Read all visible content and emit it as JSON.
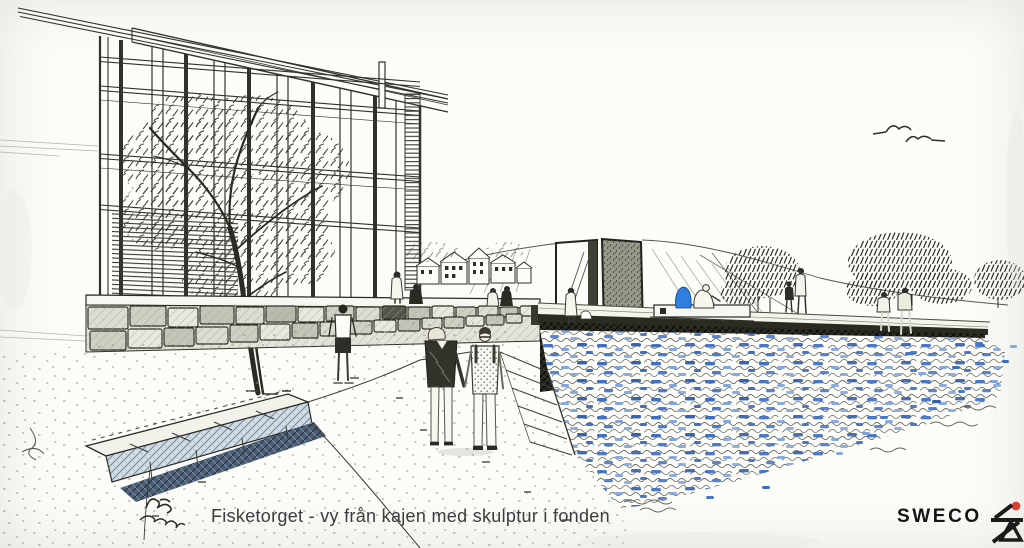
{
  "title": "Fisketorget arkitekturskiss",
  "caption": {
    "text": "Fisketorget - vy från kajen med skulptur i fonden"
  },
  "signature": {
    "description": "illegible handwritten artist signature, two lines of cursive scribble"
  },
  "logo": {
    "text": "SWECO",
    "dot_color": "#d9402f",
    "mark_color": "#1b1b19"
  },
  "palette": {
    "paper": "#fcfcf9",
    "ink": "#2e2e27",
    "ink_light": "#6a6a60",
    "stone": "#dcdcd2",
    "water_blue": "#3c6cc0",
    "water_blue_light": "#7fa3dc",
    "figure_blue": "#2f7fe0",
    "shadow_dark": "#23231c",
    "bench_shadow_blue": "#44586e",
    "caption_grey": "#3c3c3c"
  },
  "scene": {
    "description": "Hand-drawn perspective sketch of Fisketorget seen from the quay: glazed modernist building and large tree at left, stone retaining wall, two-slab stone sculpture on a hill with small houses, people strolling and sitting along the waterfront promenade, water rendered with blue ink dabs and wave squiggles, two gulls in the sky",
    "birds_count": 2
  }
}
